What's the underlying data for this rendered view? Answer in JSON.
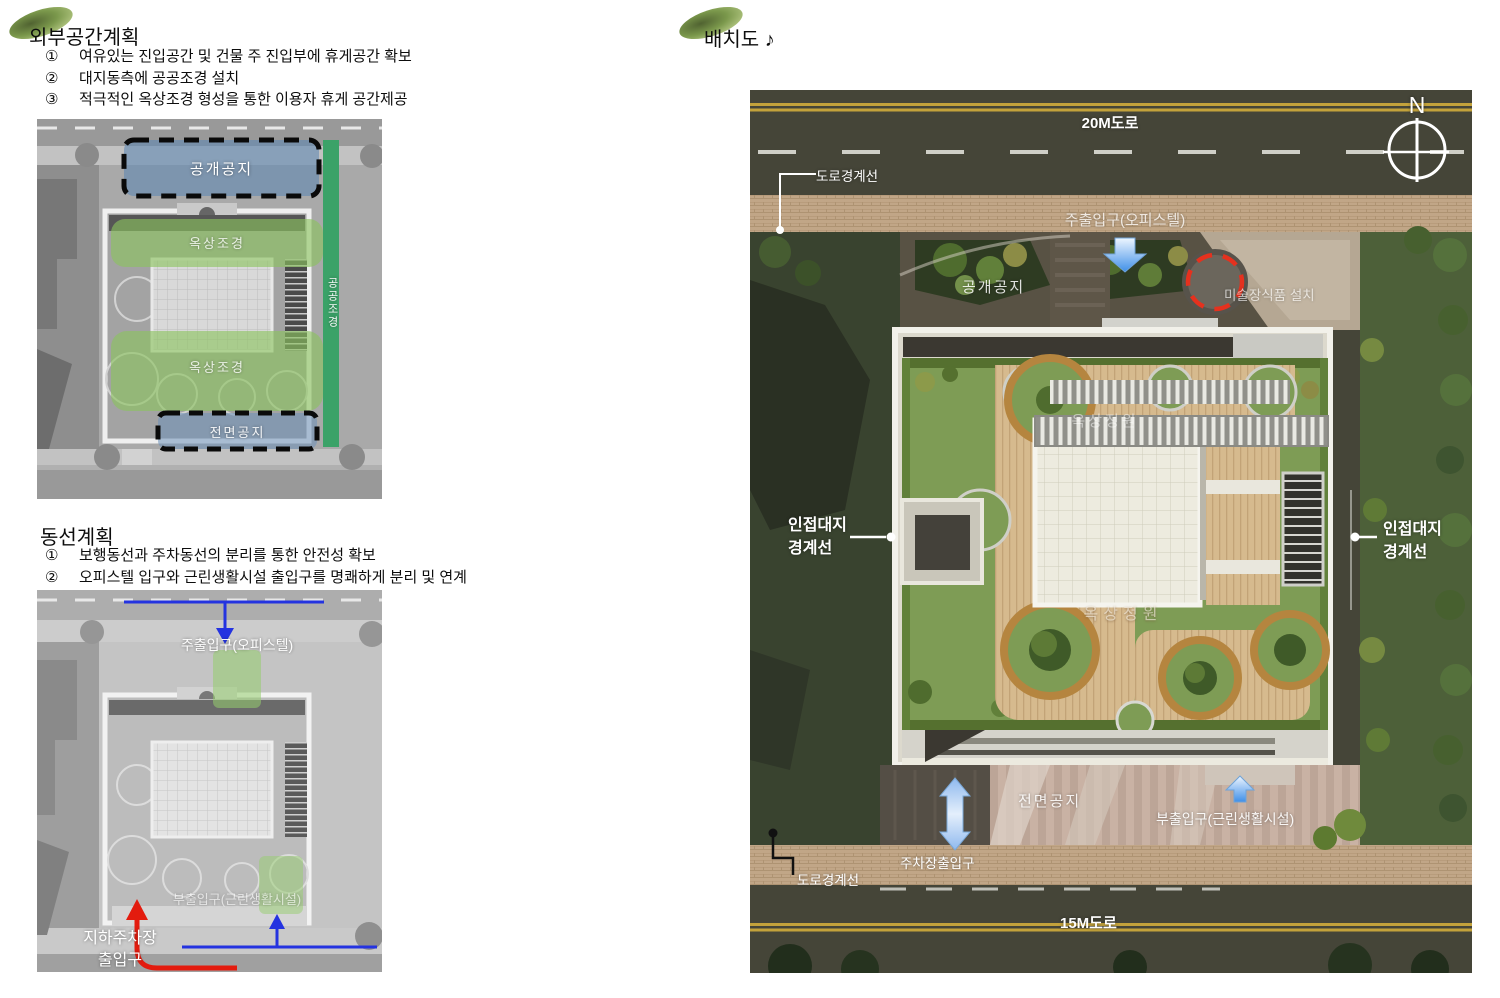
{
  "colors": {
    "leaf_green": "#6f8f3c",
    "overlay_green": "#8bc35e",
    "overlay_blue": "#6088b2",
    "public_strip_green": "#3ba268",
    "circulation_arrow_blue": "#2433e0",
    "circulation_arrow_red": "#e31b0e",
    "art_highlight_red": "#e5311e",
    "road_line_yellow": "#c3a23b"
  },
  "left_column": {
    "section1": {
      "title": "외부공간계획",
      "items": [
        {
          "num": "①",
          "text": "여유있는 진입공간 및 건물 주 진입부에 휴게공간 확보"
        },
        {
          "num": "②",
          "text": "대지동측에 공공조경 설치"
        },
        {
          "num": "③",
          "text": "적극적인 옥상조경 형성을 통한 이용자 휴게 공간제공"
        }
      ]
    },
    "plan1_labels": {
      "open_space": "공개공지",
      "roof_landscape_top": "옥상조경",
      "roof_landscape_bottom": "옥상조경",
      "public_landscape_strip": "공공조경",
      "front_space": "전면공지"
    },
    "section2": {
      "title": "동선계획",
      "items": [
        {
          "num": "①",
          "text": "보행동선과 주차동선의 분리를 통한 안전성 확보"
        },
        {
          "num": "②",
          "text": "오피스텔 입구와 근린생활시설 출입구를 명쾌하게 분리 및 연계"
        }
      ]
    },
    "plan2_labels": {
      "main_entrance": "주출입구(오피스텔)",
      "sub_entrance": "부출입구(근린생활시설)",
      "underground_parking_line1": "지하주차장",
      "underground_parking_line2": "출입구"
    }
  },
  "site_plan": {
    "title": "배치도 ♪",
    "compass_north": "N",
    "road_top": "20M도로",
    "road_bottom": "15M도로",
    "road_boundary_top": "도로경계선",
    "road_boundary_bottom": "도로경계선",
    "main_entrance": "주출입구(오피스텔)",
    "open_space": "공개공지",
    "art_feature": "미술장식품 설치",
    "adjacent_left_line1": "인접대지",
    "adjacent_left_line2": "경계선",
    "adjacent_right_line1": "인접대지",
    "adjacent_right_line2": "경계선",
    "roof_garden_top": "옥상정원",
    "roof_garden_bottom": "옥상정원",
    "front_space": "전면공지",
    "sub_entrance": "부출입구(근린생활시설)",
    "parking_entrance": "주차장출입구"
  }
}
